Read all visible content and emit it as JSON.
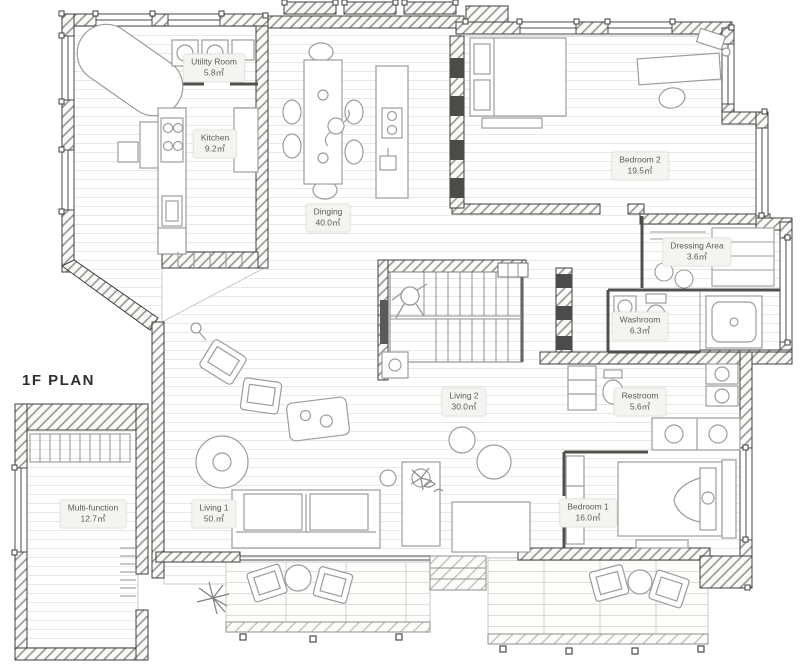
{
  "plan": {
    "title": "1F PLAN"
  },
  "rooms": [
    {
      "name": "Utility Room",
      "area": "5.8㎡"
    },
    {
      "name": "Kitchen",
      "area": "9.2㎡"
    },
    {
      "name": "Dinging",
      "area": "40.0㎡"
    },
    {
      "name": "Bedroom 2",
      "area": "19.5㎡"
    },
    {
      "name": "Dressing Area",
      "area": "3.6㎡"
    },
    {
      "name": "Washroom",
      "area": "6.3㎡"
    },
    {
      "name": "Restroom",
      "area": "5.6㎡"
    },
    {
      "name": "Living 2",
      "area": "30.0㎡"
    },
    {
      "name": "Living 1",
      "area": "50.㎡"
    },
    {
      "name": "Bedroom 1",
      "area": "16.0㎡"
    },
    {
      "name": "Multi-function",
      "area": "12.7㎡"
    }
  ]
}
